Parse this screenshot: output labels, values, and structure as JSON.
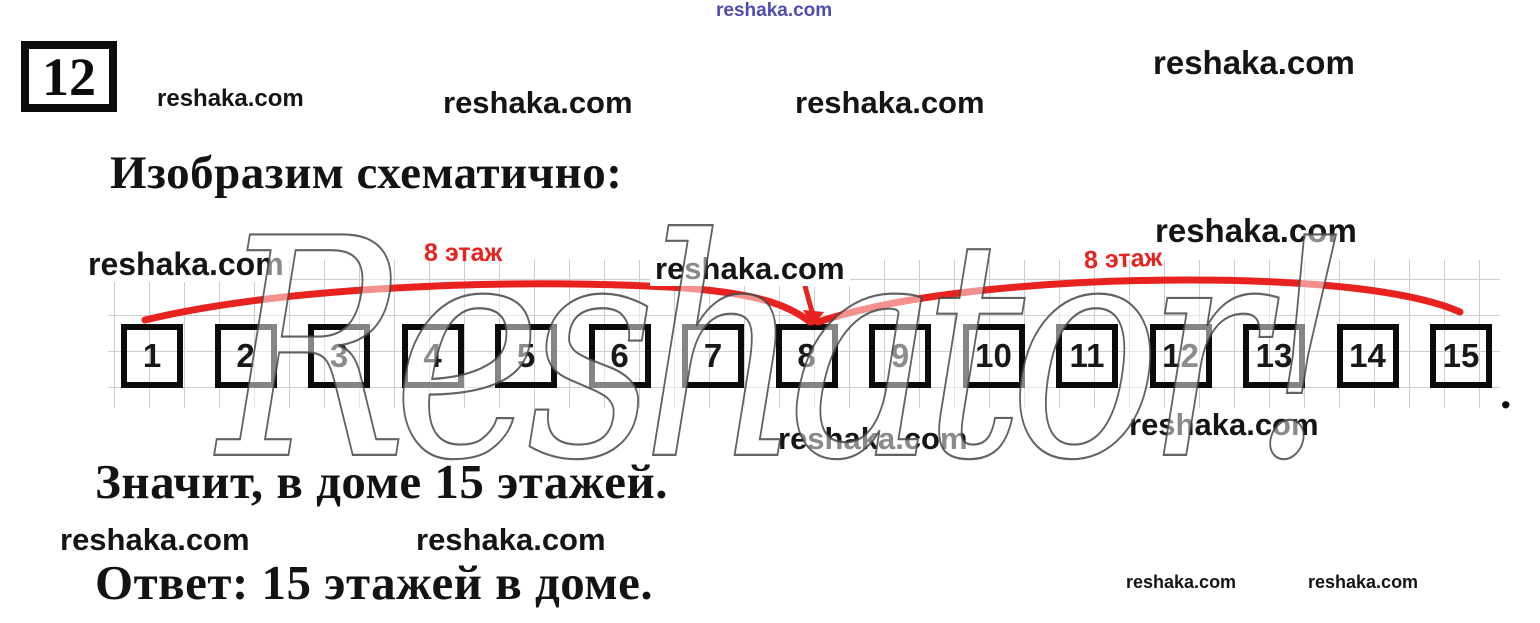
{
  "problem_number": "12",
  "watermark": {
    "text": "reshaka.com",
    "big_text": "Reshator!"
  },
  "colors": {
    "red": "#e8221e",
    "blue_watermark": "#312da8",
    "text": "#131313"
  },
  "heading": "Изобразим схематично:",
  "diagram": {
    "floors": [
      "1",
      "2",
      "3",
      "4",
      "5",
      "6",
      "7",
      "8",
      "9",
      "10",
      "11",
      "12",
      "13",
      "14",
      "15"
    ],
    "left_arc_label": "8 этаж",
    "right_arc_label": "8 этаж",
    "pointed_floor": "8",
    "period": "."
  },
  "conclusion": "Значит, в доме 15 этажей.",
  "answer": "Ответ: 15 этажей в доме."
}
